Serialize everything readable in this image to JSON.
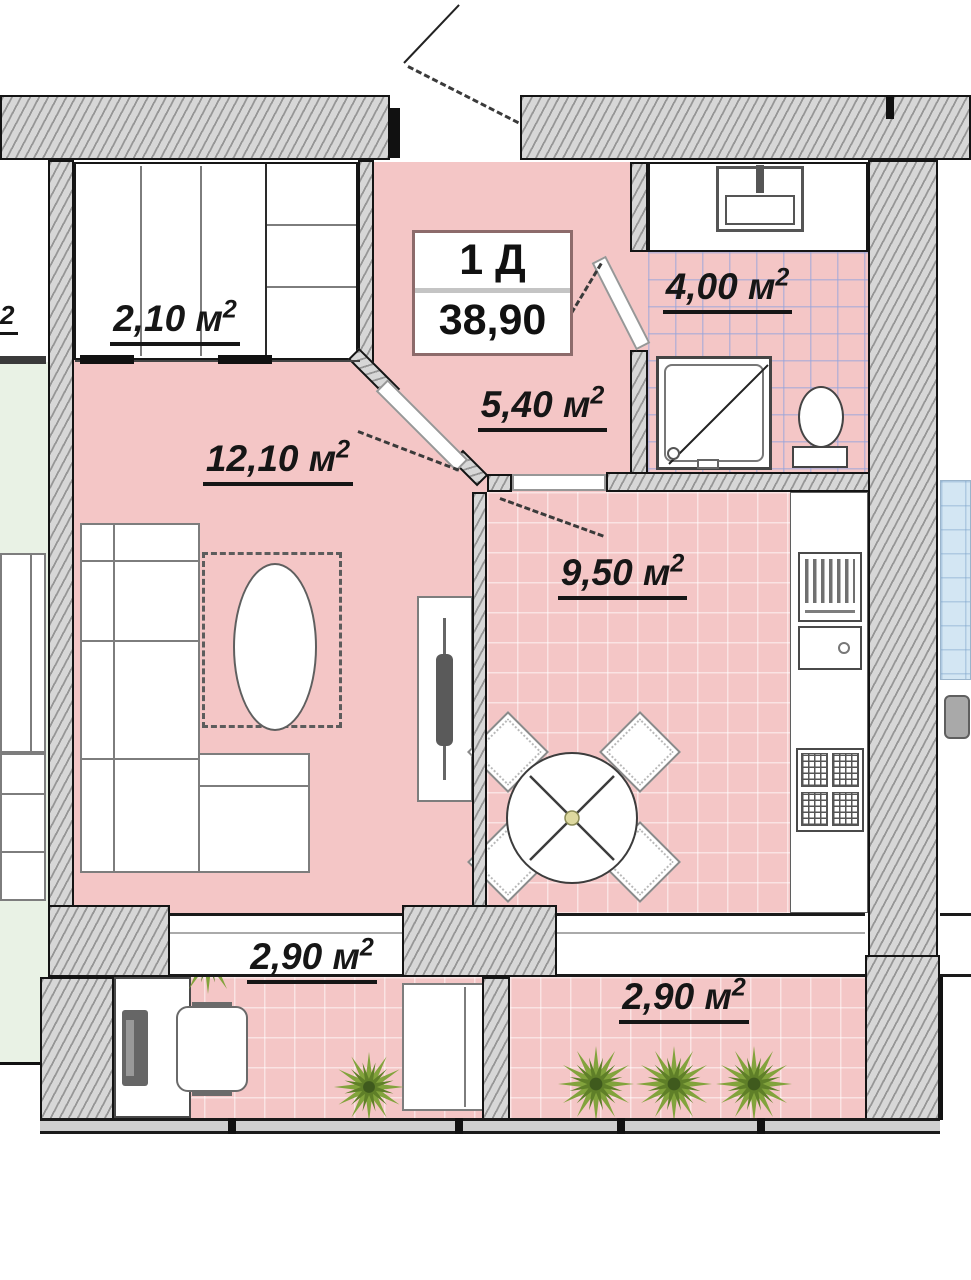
{
  "plan": {
    "unit_label": "1 Д",
    "unit_area": "38,90",
    "area_unit": "м",
    "area_sup": "2",
    "rooms": {
      "closet": "2,10",
      "bathroom": "4,00",
      "hallway": "5,40",
      "living_room": "12,10",
      "kitchen": "9,50",
      "balcony_left": "2,90",
      "balcony_right": "2,90"
    },
    "adjacent_left_label_fragment": "2",
    "colors": {
      "floor_pink": "#f4c6c6",
      "bath_tile_line": "#96a5dc",
      "adjacent_floor_green": "#e9f2e5",
      "adjacent_tile_blue": "#d3e6f3",
      "wall_fill": "#d7d7d7",
      "plant_green": "#82a33c",
      "title_border": "#8d6b6b"
    }
  }
}
